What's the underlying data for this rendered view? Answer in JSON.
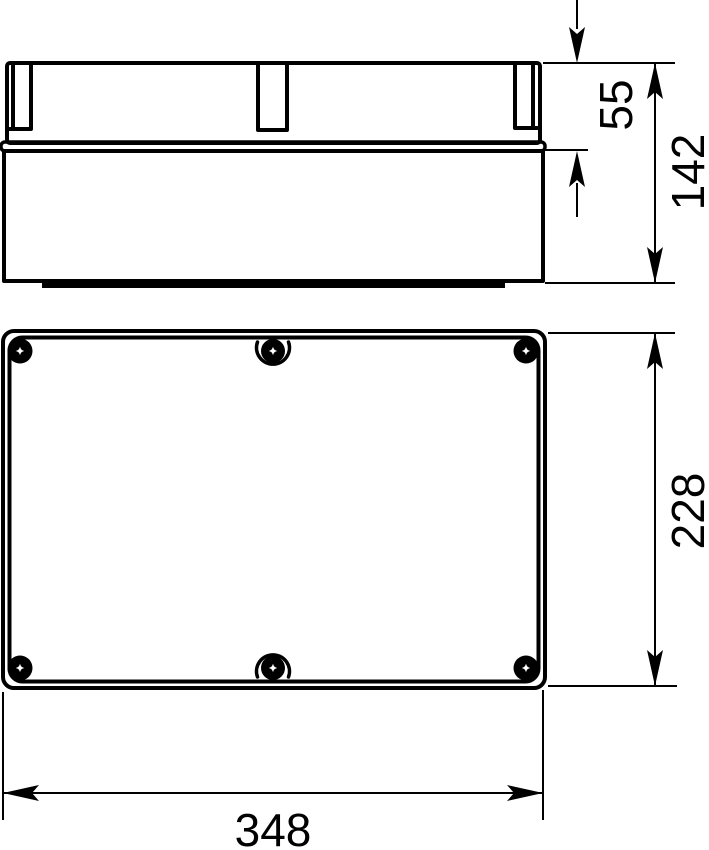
{
  "drawing": {
    "type": "technical-dimension-drawing",
    "subject": "rectangular enclosure box with screwed lid, two orthographic views",
    "colors": {
      "line": "#000000",
      "background": "#ffffff"
    },
    "views": {
      "side": {
        "name": "side elevation (lid on box)"
      },
      "plan": {
        "name": "top plan (lid with 6 screws)"
      }
    },
    "dimensions": [
      {
        "id": "lid-height",
        "label": "55",
        "view": "side",
        "orientation": "vertical"
      },
      {
        "id": "total-height",
        "label": "142",
        "view": "side",
        "orientation": "vertical"
      },
      {
        "id": "box-depth",
        "label": "228",
        "view": "plan",
        "orientation": "vertical"
      },
      {
        "id": "box-width",
        "label": "348",
        "view": "plan",
        "orientation": "horizontal"
      }
    ]
  }
}
